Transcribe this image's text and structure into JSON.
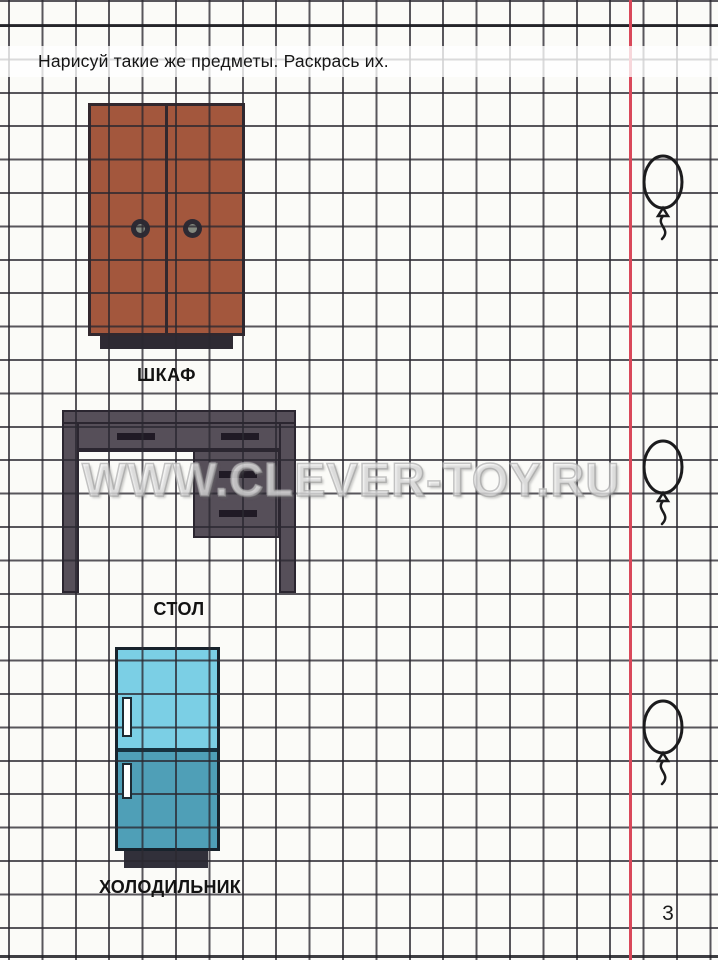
{
  "header": {
    "instruction": "Нарисуй такие же предметы. Раскрась их."
  },
  "watermark": {
    "text": "WWW.CLEVER-TOY.RU"
  },
  "footer": {
    "page_number": "3"
  },
  "margin": {
    "line_color": "#d9485a"
  },
  "ink_color": "#1b1b1d",
  "items": [
    {
      "id": "wardrobe",
      "label": "ШКАФ",
      "colors": {
        "body": "#a3573d",
        "outline": "#32282e",
        "base": "#2e2a33",
        "knob": "#2e2a33",
        "knob_center": "#84897f"
      }
    },
    {
      "id": "desk",
      "label": "СТОЛ",
      "colors": {
        "body": "#564f59",
        "outline": "#2b2630",
        "handle": "#201a25"
      }
    },
    {
      "id": "fridge",
      "label": "ХОЛОДИЛЬНИК",
      "colors": {
        "top_door": "#7bcfe5",
        "bottom_door": "#4f9fb7",
        "outline": "#18232c",
        "door_divider": "#16323f",
        "base": "#31303a",
        "handle_fill": "#ffffff",
        "handle_outline": "#1d2a33"
      }
    }
  ],
  "decorations": {
    "balloon_count": "3"
  }
}
